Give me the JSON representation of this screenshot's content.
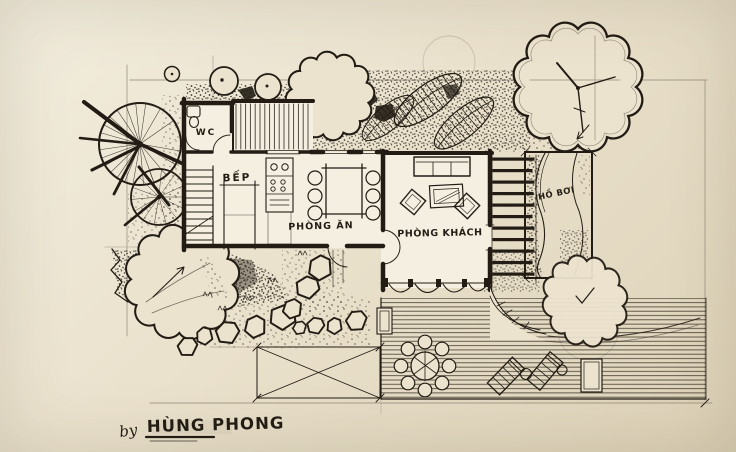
{
  "drawing": {
    "rooms": {
      "wc": "WC",
      "kitchen": "BẾP",
      "dining": "PHÒNG ĂN",
      "living": "PHÒNG KHÁCH",
      "pool": "HỒ BƠI"
    },
    "signature": {
      "prefix": "by",
      "name": "HÙNG PHONG"
    },
    "colors": {
      "paper_light": "#f2edde",
      "paper_dark": "#ddd2b8",
      "ink": "#221c14",
      "pencil": "#9b9180"
    }
  }
}
